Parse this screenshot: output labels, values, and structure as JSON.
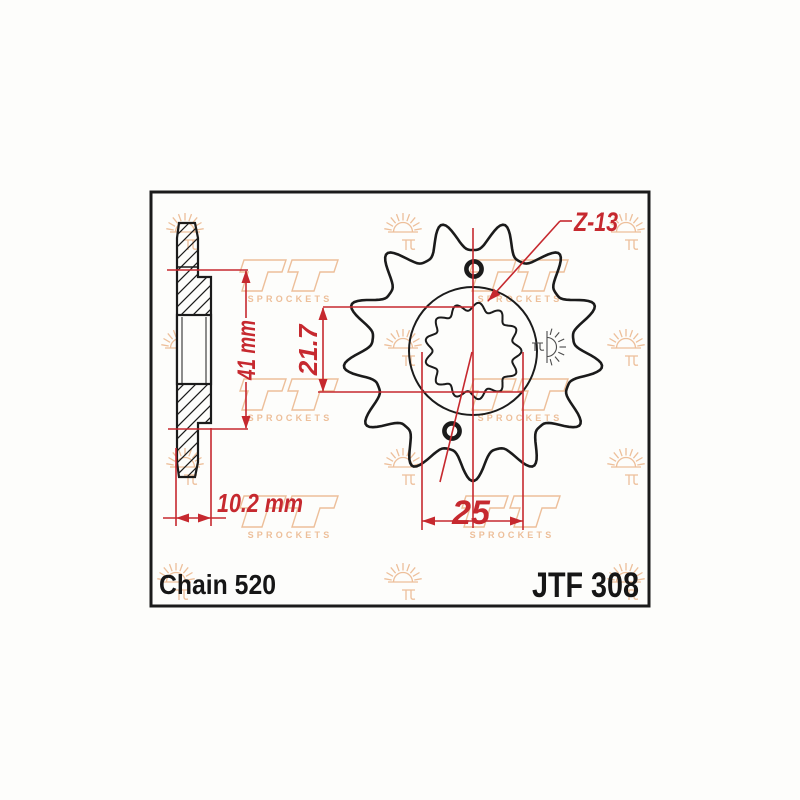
{
  "drawing": {
    "part_number": "JTF 308",
    "chain_label": "Chain 520",
    "teeth_label": "Z-13",
    "teeth_count": 13,
    "dimensions": {
      "overall_height": "41 mm",
      "hub_width": "10.2 mm",
      "bore_height": "21.7",
      "bore_width": "25"
    }
  },
  "watermark": {
    "brand_text": "SPROCKETS",
    "color": "#edbf9a"
  },
  "colors": {
    "dimension_red": "#c6292f",
    "line_black": "#1b1b1b",
    "stamp_gray": "#4a4a4a",
    "background": "#fdfdfb"
  }
}
